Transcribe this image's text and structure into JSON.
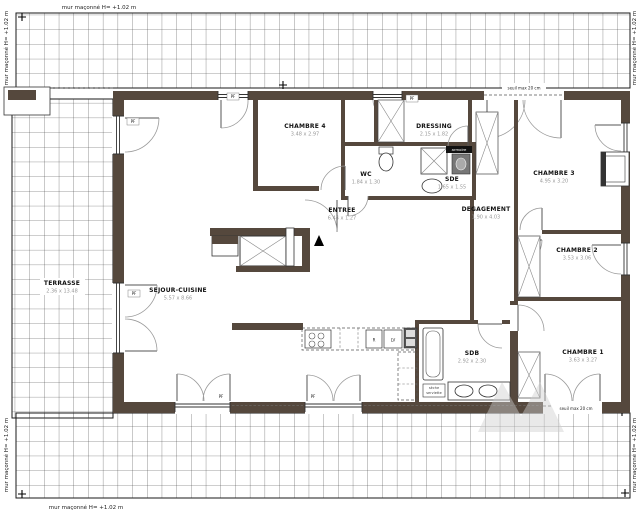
{
  "annotations": {
    "mur": "mur maçonné H= +1.02 m",
    "seuil": "seuil max 20 cm",
    "pf": "PF",
    "armoire": "armoire",
    "seche_line1": "sèche",
    "seche_line2": "serviette",
    "fridge": "R",
    "dishwasher": "LV"
  },
  "rooms": {
    "terrasse": {
      "name": "TERRASSE",
      "dims": "2.36 x 13.48"
    },
    "sejour": {
      "name": "SEJOUR-CUISINE",
      "dims": "5.57 x 8.66"
    },
    "chambre4": {
      "name": "CHAMBRE 4",
      "dims": "3.48 x 2.97"
    },
    "dressing": {
      "name": "DRESSING",
      "dims": "2.15 x 1.82"
    },
    "wc": {
      "name": "WC",
      "dims": "1.84 x 1.30"
    },
    "sde": {
      "name": "SDE",
      "dims": "1.65 x 1.55"
    },
    "entree": {
      "name": "ENTREE",
      "dims": "6.44 x 1.27"
    },
    "degagement": {
      "name": "DEGAGEMENT",
      "dims": "1.90 x 4.03"
    },
    "chambre3": {
      "name": "CHAMBRE 3",
      "dims": "4.95 x 3.20"
    },
    "chambre2": {
      "name": "CHAMBRE 2",
      "dims": "3.53 x 3.06"
    },
    "chambre1": {
      "name": "CHAMBRE 1",
      "dims": "3.63 x 3.27"
    },
    "sdb": {
      "name": "SDB",
      "dims": "2.92 x 2.30"
    }
  },
  "colors": {
    "wall": "#55483d",
    "grid_line": "#3a3a3a",
    "dim_text": "#9a9a9a"
  }
}
